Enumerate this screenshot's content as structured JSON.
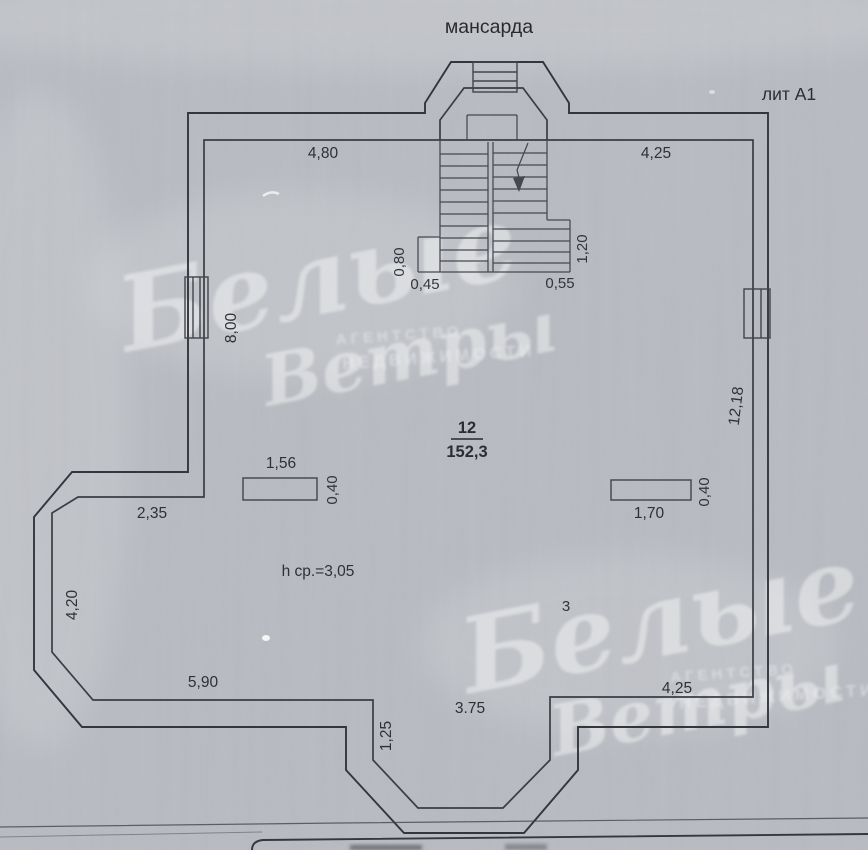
{
  "header": {
    "floor_title": "мансарда",
    "building_liter": "лит А1"
  },
  "room": {
    "number": "12",
    "area": "152,3",
    "avg_height_note": "h ср.=3,05",
    "stray_mark": "3"
  },
  "dimensions": {
    "top_left_width": "4,80",
    "top_right_width": "4,25",
    "stair_left_depth": "0,80",
    "stair_left_width": "0,45",
    "stair_right_width": "0,55",
    "stair_right_depth": "1,20",
    "left_wall_upper": "8,00",
    "right_wall": "12,18",
    "left_partition_width": "1,56",
    "left_partition_depth": "0,40",
    "right_partition_width": "1,70",
    "right_partition_depth": "0,40",
    "left_step_width": "2,35",
    "left_wall_lower": "4,20",
    "bottom_left_width": "5,90",
    "bottom_bay_width": "3.75",
    "bottom_bay_depth": "1,25",
    "bottom_right_width": "4,25"
  },
  "watermark": {
    "brand_word1": "Белые",
    "brand_word2": "Ветры",
    "agency_word1": "АГЕНТСТВО",
    "agency_word2": "НЕДВИЖИМОСТИ"
  },
  "colors": {
    "paper": "#b8bbc1",
    "ink": "#33373d",
    "watermark": "#ffffff"
  }
}
